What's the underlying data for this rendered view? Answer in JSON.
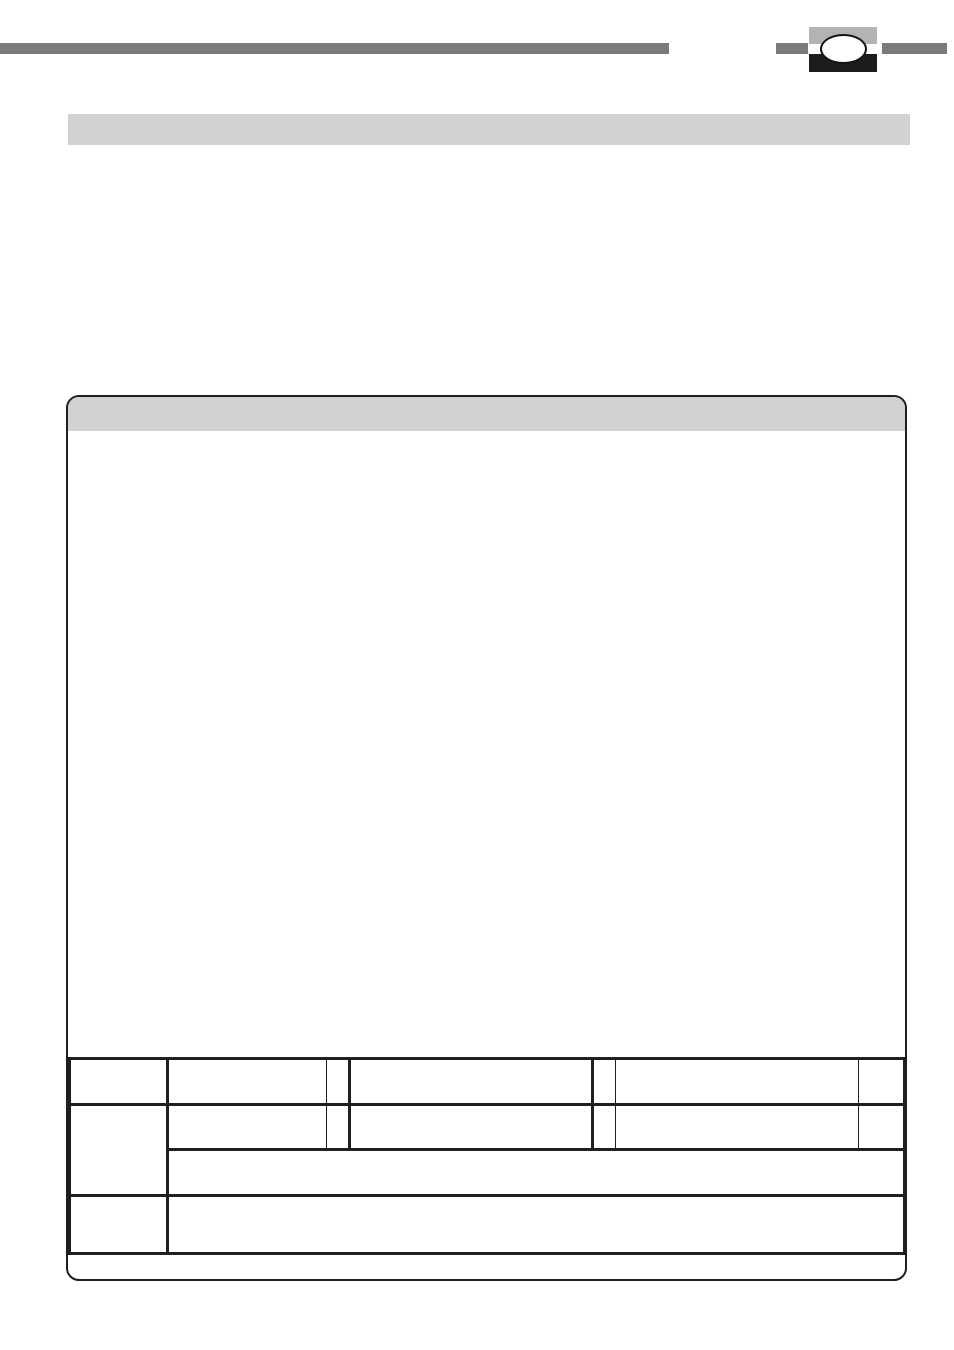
{
  "page": {
    "width_px": 954,
    "height_px": 1350,
    "background": "#ffffff"
  },
  "colors": {
    "rule_gray": "#7a7a7a",
    "logo_light_gray": "#b3b3b3",
    "logo_black": "#1c1c1c",
    "band_gray": "#d2d2d2",
    "line_dark": "#1f1f1f",
    "page_bg": "#ffffff"
  },
  "top_rule": {
    "segment_count": 3,
    "logo": {
      "icon": "oval-emblem",
      "description_visible": "white ellipse over light-gray and black blocks"
    }
  },
  "title_band": {
    "text": ""
  },
  "panel": {
    "header_band_text": "",
    "body_text": "",
    "form_table": {
      "rows": 4,
      "columns": 7,
      "column_widths_px": [
        98,
        159,
        23,
        243,
        23,
        243,
        46
      ],
      "row_heights_px": [
        46,
        45,
        46,
        58
      ],
      "merges": [
        "row2-col1 spans rows 2-3",
        "row3 cell spans columns 2-7",
        "row4 cell spans columns 2-7"
      ],
      "cells_text": ""
    }
  }
}
